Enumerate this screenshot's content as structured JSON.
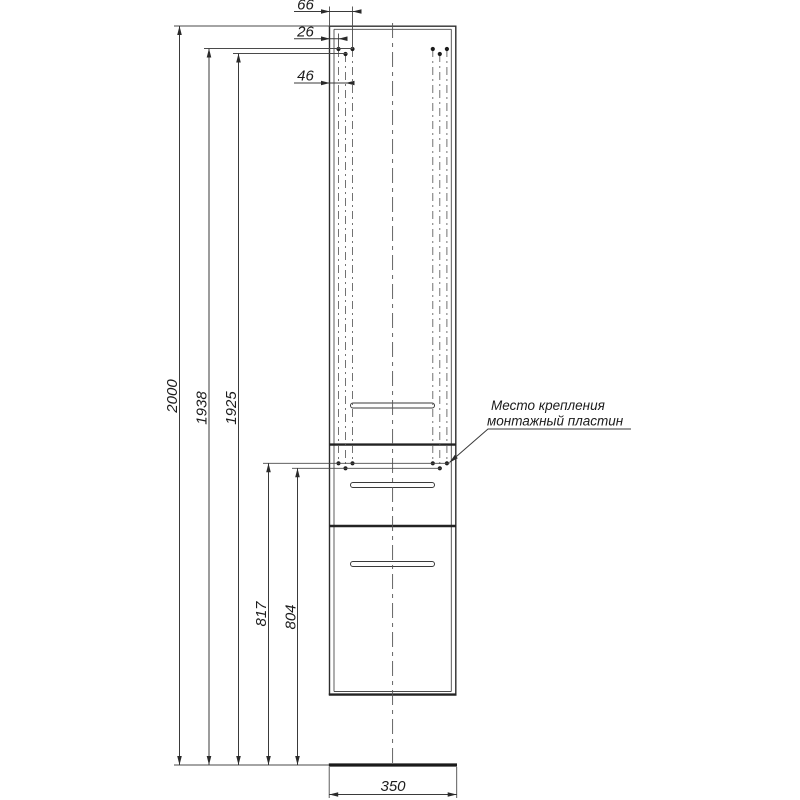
{
  "dims": {
    "total_height": "2000",
    "top_holes_outer_row": "1938",
    "top_holes_mid_row": "1925",
    "bottom_holes_outer_row": "817",
    "bottom_holes_mid_row": "804",
    "hole_offset_outer": "66",
    "hole_offset_edge": "26",
    "hole_offset_mid": "46",
    "base_width": "350"
  },
  "annotation": {
    "mounting_note_line1": "Место крепления",
    "mounting_note_line2": "монтажный пластин"
  },
  "colors": {
    "line": "#3a3a3a",
    "text": "#1c1c1c",
    "background": "#ffffff"
  }
}
